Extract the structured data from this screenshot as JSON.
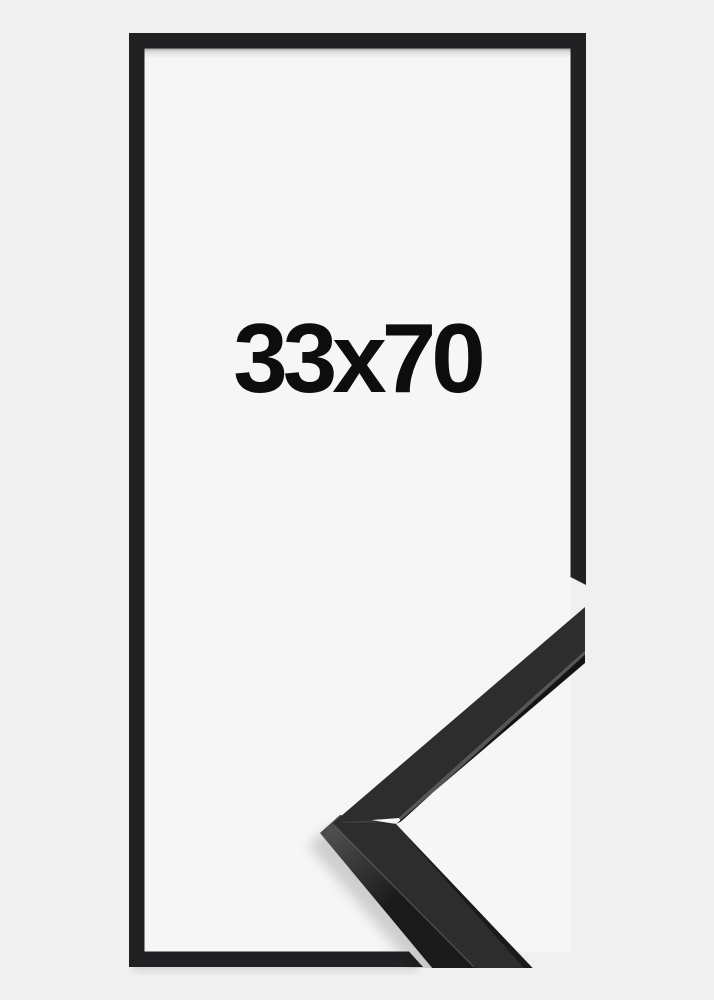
{
  "page": {
    "background_color": "#f0f0f1"
  },
  "frame_preview": {
    "size_label": "33x70",
    "frame_color": "#212123",
    "backing_color": "#f6f6f7",
    "label_color": "#0d0d0d"
  },
  "corner_sample": {
    "top_face_color": "#2d2d2d",
    "side_face_color": "#1a1a1a",
    "corner_highlight_color": "#4f4f4f",
    "edge_highlight_color": "#555555",
    "lip_shadow_color": "#141414"
  }
}
